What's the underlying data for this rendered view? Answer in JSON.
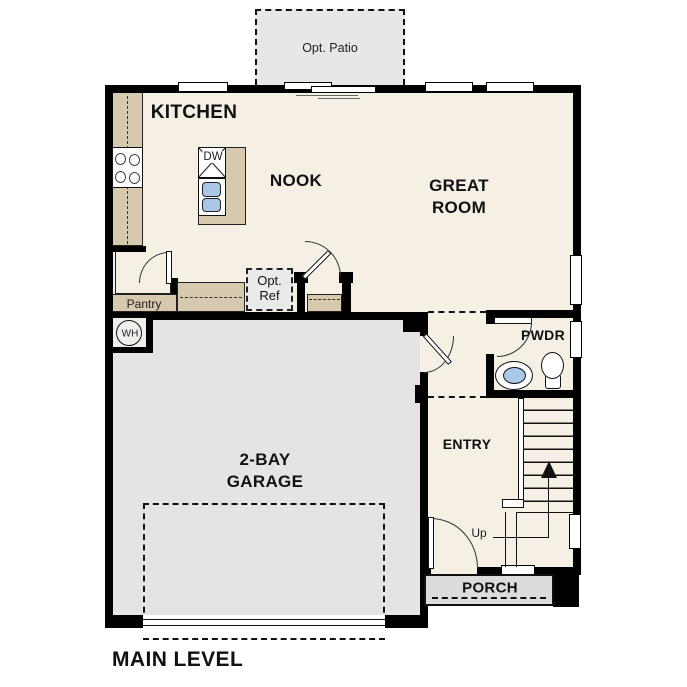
{
  "plan_title": "MAIN LEVEL",
  "rooms": {
    "kitchen": "KITCHEN",
    "nook": "NOOK",
    "great_room_line1": "GREAT",
    "great_room_line2": "ROOM",
    "pwdr": "PWDR",
    "entry": "ENTRY",
    "garage_line1": "2-BAY",
    "garage_line2": "GARAGE",
    "porch": "PORCH",
    "pantry": "Pantry"
  },
  "annotations": {
    "opt_patio": "Opt. Patio",
    "opt_ref_line1": "Opt.",
    "opt_ref_line2": "Ref",
    "dishwasher": "DW",
    "water_heater": "WH",
    "stairs_up": "Up"
  },
  "colors": {
    "wall": "#000000",
    "floor": "#f6efe3",
    "counter": "#d7c9ad",
    "garage_floor": "#e4e4e2",
    "patio": "#e7e7e5",
    "porch": "#dcdcdc",
    "opt_ref_fill": "#eaeaea",
    "sink_blue": "#a9c7e7",
    "wh_closet": "#efefec"
  }
}
